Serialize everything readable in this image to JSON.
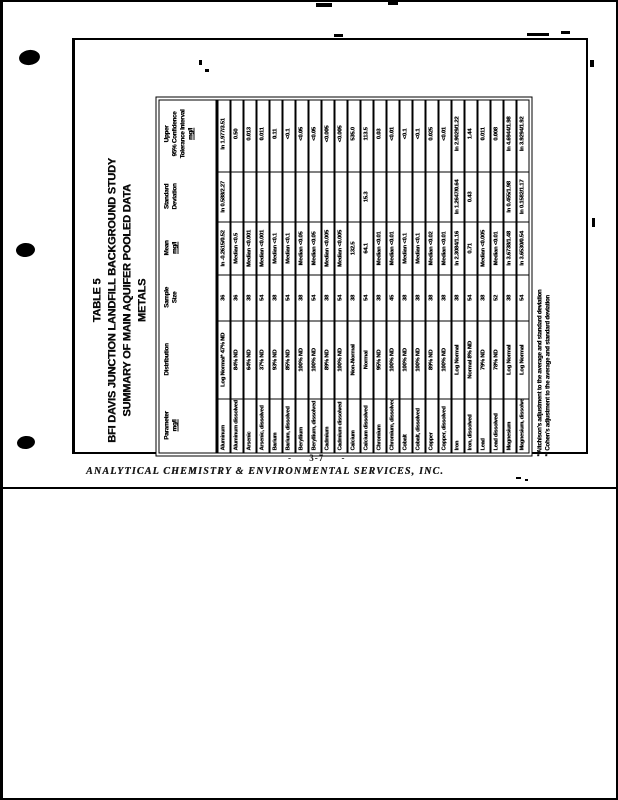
{
  "page": {
    "title_lines": [
      "TABLE 5",
      "BFI DAVIS JUNCTION LANDFILL BACKGROUND STUDY",
      "SUMMARY OF MAIN AQUIFER POOLED DATA",
      "METALS"
    ],
    "page_number": "- 3-7 -",
    "footer_line": "ANALYTICAL CHEMISTRY & ENVIRONMENTAL SERVICES, INC.",
    "footnotes": [
      "* Aitchison's adjustment to the average and standard deviation",
      "** Cohen's adjustment to the average and standard deviation"
    ]
  },
  "table": {
    "headers": [
      {
        "lines": [
          "Parameter",
          "mg/l"
        ]
      },
      {
        "lines": [
          "Distribution"
        ]
      },
      {
        "lines": [
          "Sample",
          "Size"
        ]
      },
      {
        "lines": [
          "Mean",
          "mg/l"
        ]
      },
      {
        "lines": [
          "Standard",
          "Deviation"
        ]
      },
      {
        "lines": [
          "Upper",
          "95% Confidence",
          "Tolerance Interval",
          "mg/l"
        ]
      }
    ],
    "rows": [
      [
        "Aluminum",
        "Log Normal* 47% ND",
        "36",
        "ln -0.2615/0.52",
        "ln 0.588/2.27",
        "ln 1.977/3.51"
      ],
      [
        "Aluminum dissolved",
        "84% ND",
        "36",
        "Median <0.5",
        "",
        "0.50"
      ],
      [
        "Arsenic",
        "64% ND",
        "38",
        "Median <0.001",
        "",
        "0.013"
      ],
      [
        "Arsenic, dissolved",
        "37% ND",
        "54",
        "Median <0.001",
        "",
        "0.011"
      ],
      [
        "Barium",
        "93% ND",
        "38",
        "Median <0.1",
        "",
        "0.11"
      ],
      [
        "Barium, dissolved",
        "85% ND",
        "54",
        "Median <0.1",
        "",
        "<0.1"
      ],
      [
        "Beryllium",
        "100% ND",
        "38",
        "Median <0.05",
        "",
        "<0.05"
      ],
      [
        "Beryllium, dissolved",
        "100% ND",
        "54",
        "Median <0.05",
        "",
        "<0.05"
      ],
      [
        "Cadmium",
        "89% ND",
        "38",
        "Median <0.005",
        "",
        "<0.005"
      ],
      [
        "Cadmium dissolved",
        "100% ND",
        "54",
        "Median <0.005",
        "",
        "<0.005"
      ],
      [
        "Calcium",
        "Non-Normal",
        "38",
        "132.5",
        "",
        "535.0"
      ],
      [
        "Calcium dissolved",
        "Normal",
        "54",
        "64.1",
        "15.3",
        "113.5"
      ],
      [
        "Chromium",
        "95% ND",
        "38",
        "Median <0.01",
        "",
        "0.03"
      ],
      [
        "Chromium, dissolved",
        "100% ND",
        "45",
        "Median <0.01",
        "",
        "<0.01"
      ],
      [
        "Cobalt",
        "100% ND",
        "38",
        "Median <0.1",
        "",
        "<0.1"
      ],
      [
        "Cobalt, dissolved",
        "100% ND",
        "38",
        "Median <0.1",
        "",
        "<0.1"
      ],
      [
        "Copper",
        "89% ND",
        "38",
        "Median <0.02",
        "",
        "0.025"
      ],
      [
        "Copper, dissolved",
        "100% ND",
        "38",
        "Median <0.01",
        "",
        "<0.01"
      ],
      [
        "Iron",
        "Log Normal",
        "38",
        "ln 2.3084/1.16",
        "ln 1.2647/0.64",
        "ln 2.9029/1.22"
      ],
      [
        "Iron, dissolved",
        "Normal 8% ND",
        "54",
        "0.71",
        "0.43",
        "1.44"
      ],
      [
        "Lead",
        "79% ND",
        "38",
        "Median <0.005",
        "",
        "0.011"
      ],
      [
        "Lead dissolved",
        "78% ND",
        "52",
        "Median <0.01",
        "",
        "0.008"
      ],
      [
        "Magnesium",
        "Log Normal",
        "38",
        "ln 3.6738/1.48",
        "ln 0.455/1.98",
        "ln 4.6944/1.98"
      ],
      [
        "Magnesium, dissolved",
        "Log Normal",
        "54",
        "ln 3.6530/0.54",
        "ln 0.1582/1.17",
        "ln 3.9294/1.92"
      ]
    ]
  }
}
